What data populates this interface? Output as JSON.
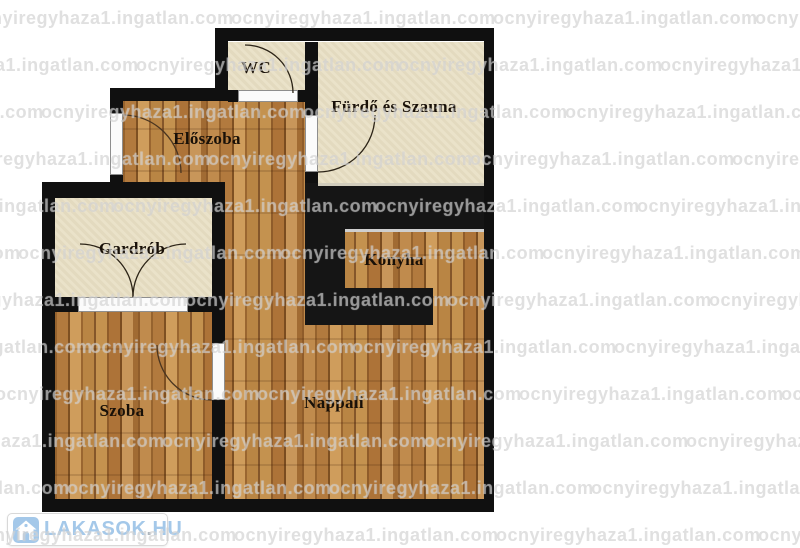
{
  "watermark": {
    "text": "ocnyiregyhaza1.ingatlan.com"
  },
  "logo": {
    "brand": "LAKASOK",
    "dot": ".",
    "tld": "HU"
  },
  "rooms": {
    "wc": {
      "label": "WC"
    },
    "furdo": {
      "label": "Fürdő és Szauna"
    },
    "eloszoba": {
      "label": "Előszoba"
    },
    "gardrob": {
      "label": "Gardrób"
    },
    "konyha": {
      "label": "Konyha"
    },
    "szoba": {
      "label": "Szoba"
    },
    "nappali": {
      "label": "Nappali"
    }
  },
  "colors": {
    "wall": "#101010",
    "room_tile": "#e9e0c6",
    "wood": "#b97f42",
    "label_text": "#181008",
    "logo_blue": "#a4c8e9"
  }
}
